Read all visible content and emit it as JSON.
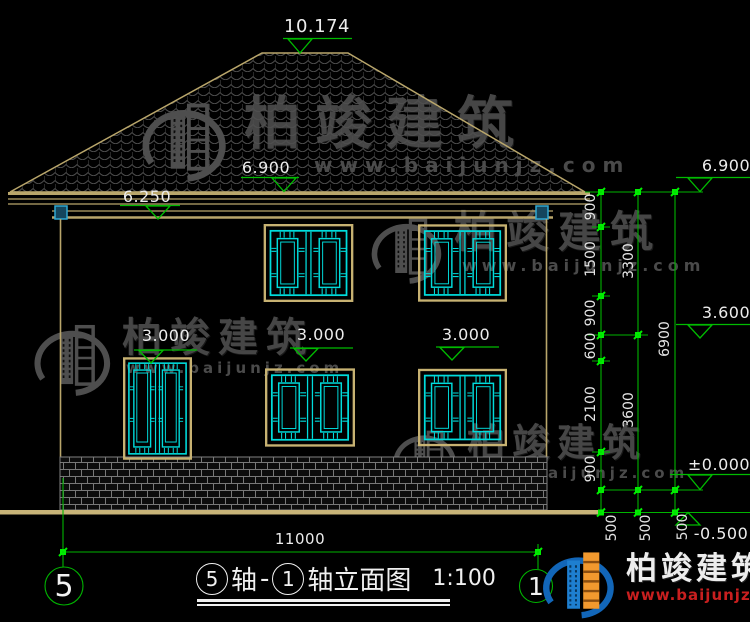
{
  "drawing": {
    "elevations": {
      "ridge": "10.174",
      "eave_center": "6.900",
      "eave_left": "6.250",
      "floor1_left": "3.000",
      "floor1_mid": "3.000",
      "floor1_right": "3.000",
      "right_eave": "6.900",
      "right_floor2": "3.600",
      "right_zero": "±0.000",
      "right_ground": "-0.500"
    },
    "dims": {
      "col1": [
        "900",
        "1500",
        "900",
        "600",
        "2100",
        "900"
      ],
      "col2": [
        "3300",
        "3600"
      ],
      "col3": [
        "6900"
      ],
      "base": [
        "500",
        "500",
        "500"
      ],
      "bottom_width": "11000"
    },
    "axes": {
      "left": "5",
      "right": "1"
    },
    "title": {
      "axis_a": "5",
      "word1": "轴",
      "dash": "-",
      "axis_b": "1",
      "word2": "轴立面图",
      "scale": "1:100"
    },
    "watermark": {
      "name": "柏竣建筑",
      "url": "www.baijunjz.com"
    },
    "brand": {
      "name": "柏竣建筑",
      "url": "www.baijunjz.com"
    }
  }
}
